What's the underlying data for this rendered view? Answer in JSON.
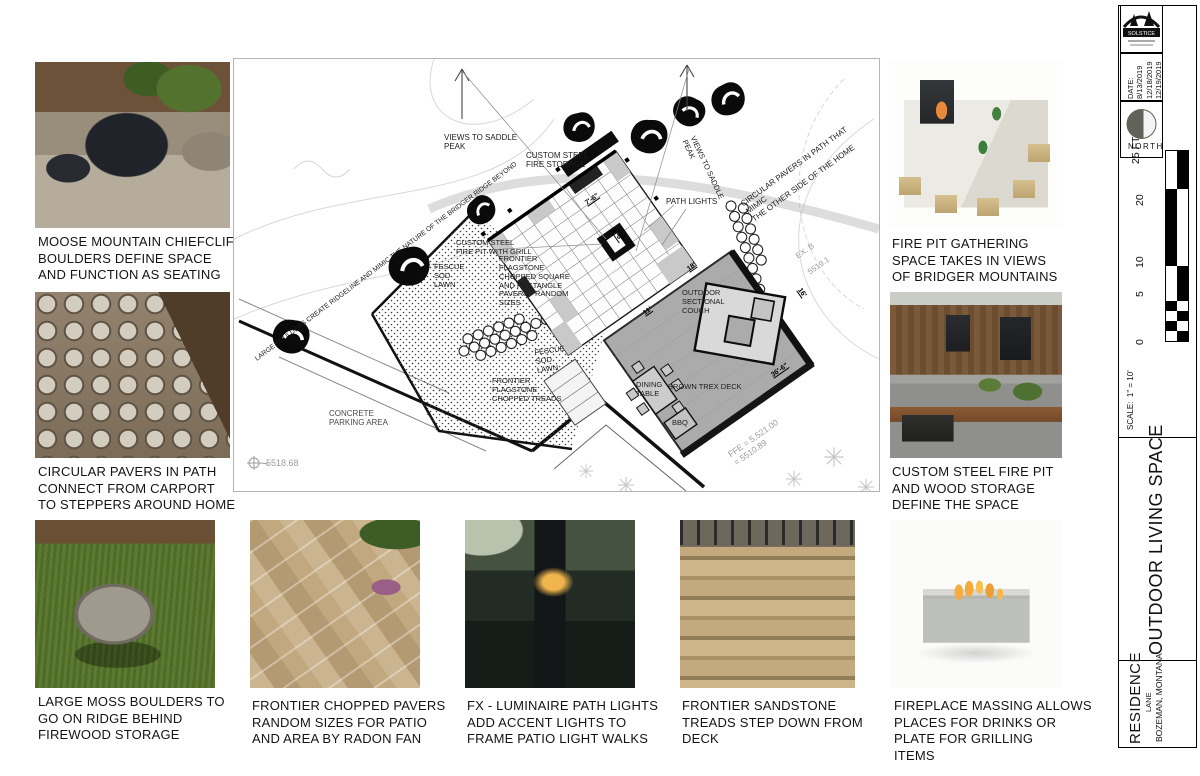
{
  "captions": {
    "moose": "MOOSE  MOUNTAIN CHIEFCLIFF\nBOULDERS DEFINE SPACE\nAND FUNCTION AS SEATING",
    "circular_pavers": "CIRCULAR PAVERS IN PATH\nCONNECT FROM CARPORT\nTO STEPPERS AROUND HOME",
    "moss_boulders": "LARGE MOSS BOULDERS TO\nGO ON RIDGE BEHIND\nFIREWOOD STORAGE",
    "chopped_pavers": "FRONTIER CHOPPED PAVERS\nRANDOM SIZES FOR PATIO\nAND AREA BY RADON FAN",
    "path_lights": "FX - LUMINAIRE PATH LIGHTS\nADD ACCENT LIGHTS TO\nFRAME PATIO LIGHT WALKS",
    "sandstone_treads": "FRONTIER SANDSTONE\nTREADS STEP DOWN FROM\nDECK",
    "fireplace_massing": "FIREPLACE MASSING ALLOWS\nPLACES FOR DRINKS OR\nPLATE FOR GRILLING\nITEMS",
    "fire_pit_gathering": "FIRE PIT GATHERING\nSPACE TAKES IN VIEWS\nOF BRIDGER MOUNTAINS",
    "steel_fire_pit": "CUSTOM STEEL FIRE PIT\nAND WOOD STORAGE\nDEFINE THE SPACE"
  },
  "plan": {
    "labels": {
      "views_saddle_1": "VIEWS TO SADDLE\nPEAK",
      "views_saddle_2": "VIEWS TO SADDLE\nPEAK",
      "circ_pavers_note": "CIRCULAR PAVERS IN PATH THAT MIMIC\nTHE OTHER SIDE OF THE HOME",
      "large_boulders_note": "LARGE BOULDERS CREATE RIDGELINE AND MIMIC THE NATURE OF THE BRIDGER RIDGE BEYOND",
      "steel_storage": "CUSTOM STEEL\nFIRE STORAGE",
      "path_lights": "PATH LIGHTS",
      "fire_pit": "CUSTOM STEEL\nFIRE PIT WITH GRILL",
      "fescue_1": "FESCUE\nSOD\nLAWN",
      "flagstone_note": "FRONTIER\nFLAGSTONE\nCHOPPED SQUARE\nAND RECTANGLE\nPAVERS - RANDOM\nSIZES",
      "fescue_2": "FESCUE\nSOD\nLAWN",
      "treads_note": "FRONTIER\nFLAGSTONE\nCHOPPED TREADS",
      "couch": "OUTDOOR\nSECTIONAL\nCOUCH",
      "dining": "DINING\nTABLE",
      "trex": "BROWN TREX DECK",
      "bbq": "BBQ",
      "parking": "CONCRETE\nPARKING AREA"
    },
    "dims": {
      "d1": "7'-6\"",
      "d2": "9'-6\"",
      "d3": "18'",
      "d4": "11'",
      "d5": "16'",
      "d6": "36'-6\""
    },
    "elevations": {
      "spot": "5518.68",
      "ffe": "FFE = 5,521.00\n=  5510.89",
      "ex1": "EX. B",
      "ex2": "5519.1"
    }
  },
  "titleblock": {
    "logo_text": "SOLSTICE",
    "date_block": "DATE:\n8/13/2019\n12/18/2019\n12/19/2019",
    "north_label": "NORTH",
    "scale_ticks": [
      "0",
      "5",
      "10",
      "20",
      "25 FT"
    ],
    "scale_note": "SCALE:  1\" = 10'",
    "sheet_title": "OUTDOOR LIVING SPACE",
    "project": "RESIDENCE",
    "project_sub": "LANE",
    "location": "BOZEMAN, MONTANA"
  }
}
